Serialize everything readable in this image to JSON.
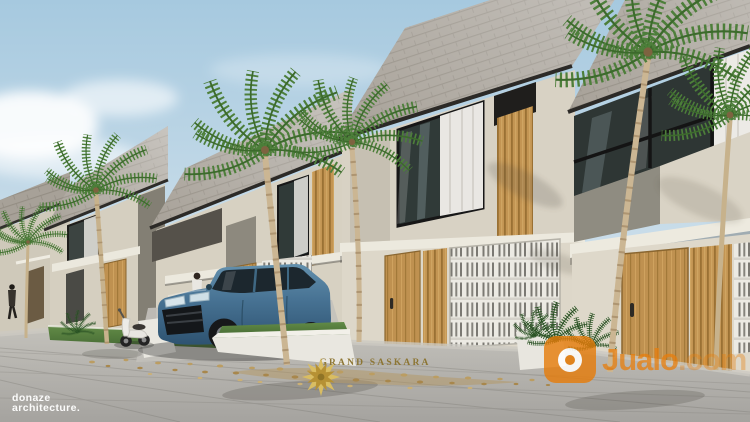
{
  "watermarks": {
    "studio": {
      "line1": "donaze",
      "line2": "architecture.",
      "color": "#ffffff"
    },
    "brand": {
      "name": "GRAND SASKARA",
      "icon": "starburst-mandala-icon",
      "color": "#8d7634"
    },
    "marketplace": {
      "name": "Jualo",
      "tld": ".com",
      "icon": "jualo-logo-icon",
      "color": "#e7800c"
    }
  },
  "scene": {
    "objects": [
      "sky",
      "clouds",
      "shingle-roof-townhouse-row",
      "palm-trees",
      "blue-suv",
      "white-scooter",
      "pedestrians",
      "breeze-block-walls",
      "timber-doors",
      "timber-slat-screens",
      "window-curtains",
      "concrete-canopies",
      "grass-strips",
      "white-planter-walls",
      "paved-street",
      "fallen-leaves"
    ],
    "colors": {
      "sky_top": "#a9cbe0",
      "sky_horizon": "#e0eaf0",
      "roof_shingle": "#a7a198",
      "fascia_dark": "#2c2a27",
      "wall_cream": "#d8d2c4",
      "wall_concrete": "#8f8c81",
      "timber": "#c0914f",
      "glass": "#2e3634",
      "curtain": "#eceae6",
      "breeze_block": "#eceae3",
      "grass": "#5a8443",
      "pavement": "#b6b4af",
      "car_blue": "#4a7b9c",
      "palm_trunk": "#c7b28c",
      "palm_leaf": "#4d7f3a",
      "leaf_debris": "#b3945a"
    }
  }
}
